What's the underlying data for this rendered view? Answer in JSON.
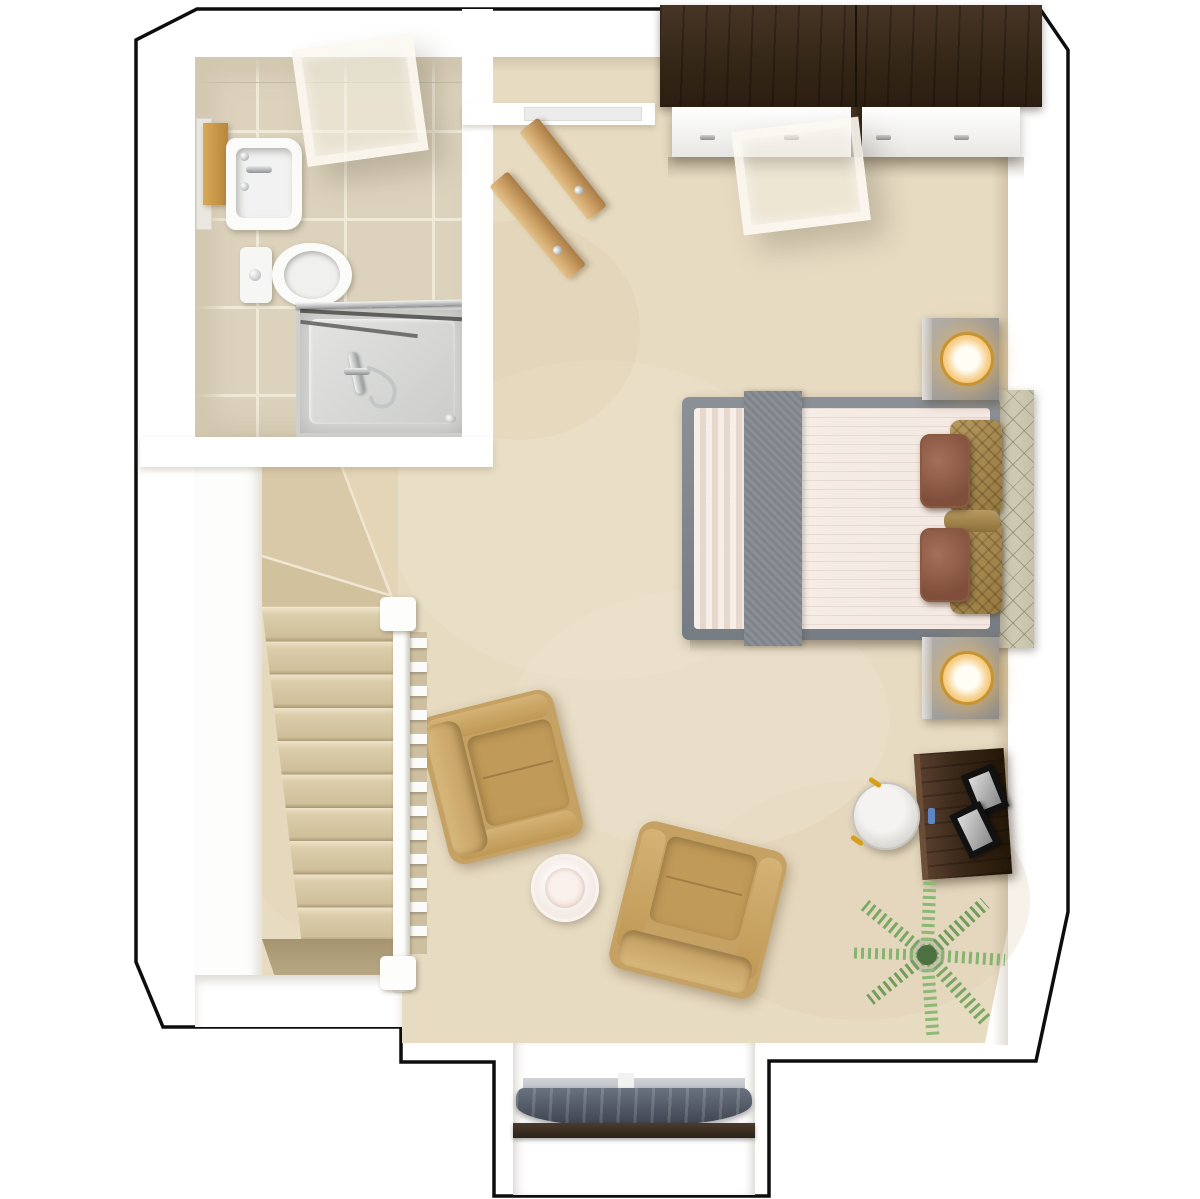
{
  "meta": {
    "view": "3d-top-down-floor-plan",
    "floor": "upper-floor-bedroom-suite",
    "visible_text": "none"
  },
  "colors": {
    "wall": "#ffffff",
    "outline": "#0d0d0d",
    "carpet": "#e7dbc2",
    "carpetLight": "#f2e9d7",
    "carpetDark": "#d7c6a5",
    "tile": "#ddd3bd",
    "grout": "#efe9d8",
    "wallTile": "#d3c9b2",
    "stairTread": "#dccdab",
    "doorWood": "#cfa368",
    "wardrobeDark": "#342717",
    "wardrobeFace": "#f2f1ef",
    "bedFrame": "#7e858c",
    "bedSheet": "#f3e8e2",
    "bedRunner": "#84898f",
    "headboard": "#d3cfb8",
    "pillowBrown": "#8d5f49",
    "pillowGold": "#a98e55",
    "chair": "#c5a164",
    "chairLight": "#d8b87c",
    "sideTable": "#f4ece7",
    "lampGold": "#c89430",
    "lampGlow": "#f2b95c",
    "accentGold": "#d4a017",
    "deskWood": "#3a2818",
    "stool": "#d9d7d3",
    "plantGreen": "#7fae6a",
    "plantDark": "#4c7040",
    "curtain": "#4a515c",
    "sill": "#2c2218",
    "showerTray": "#d8d9d7",
    "metal": "#b9b9b7"
  },
  "rooms": [
    {
      "name": "bathroom",
      "features": [
        "sink-vanity",
        "toilet",
        "shower",
        "skylight",
        "tiled-floor"
      ]
    },
    {
      "name": "bedroom",
      "features": [
        "double-bed",
        "wardrobe",
        "two-armchairs",
        "desk",
        "dormer-window",
        "skylight",
        "carpet-floor"
      ]
    },
    {
      "name": "stairwell",
      "features": [
        "winder-stairs",
        "white-banister"
      ]
    },
    {
      "name": "closet-alcove",
      "features": [
        "open-double-doors"
      ]
    }
  ],
  "furniture": [
    "wardrobe",
    "double-bed",
    "headboard",
    "nightstand-top",
    "nightstand-bottom",
    "table-lamp-top",
    "table-lamp-bottom",
    "armchair-1",
    "armchair-2",
    "round-side-table",
    "desk",
    "photo-frame-1",
    "photo-frame-2",
    "stool",
    "potted-palm",
    "sink-vanity",
    "toilet",
    "shower-enclosure",
    "dormer-curtain"
  ],
  "stairs": {
    "straight_steps": 10,
    "winder_steps": 4,
    "balusters": 13
  }
}
